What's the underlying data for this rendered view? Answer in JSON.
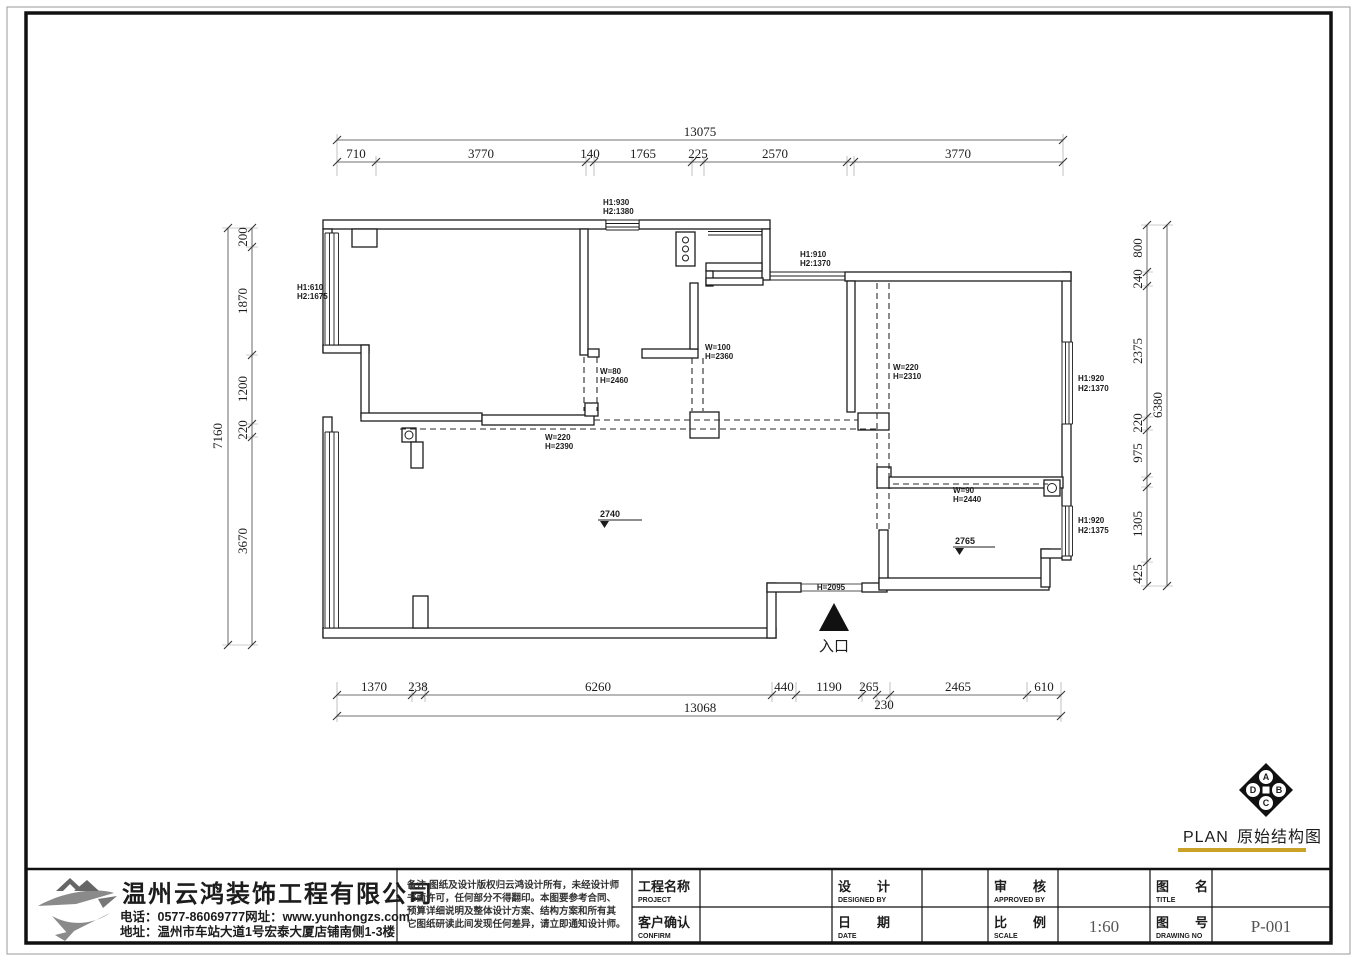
{
  "plan_title": {
    "en": "PLAN",
    "zh": "原始结构图"
  },
  "underline_color": "#c9a227",
  "dims": {
    "top_total": "13075",
    "top": [
      "710",
      "3770",
      "140",
      "1765",
      "225",
      "2570",
      "3770"
    ],
    "bottom": [
      "1370",
      "238",
      "6260",
      "440",
      "1190",
      "265",
      "2465",
      "610"
    ],
    "bottom_small": "230",
    "bottom_total": "13068",
    "left": [
      "200",
      "1870",
      "1200",
      "220",
      "3670"
    ],
    "left_total": "7160",
    "right": [
      "800",
      "240",
      "2375",
      "220",
      "975",
      "1305",
      "425"
    ],
    "right_total": "6380"
  },
  "labels": {
    "win_top_h1": "H1:930",
    "win_top_h2": "H2:1380",
    "win_right_upper_h1": "H1:910",
    "win_right_upper_h2": "H2:1370",
    "win_left_h1": "H1:610",
    "win_left_h2": "H2:1675",
    "win_east_top_h1": "H1:920",
    "win_east_top_h2": "H2:1370",
    "win_east_bottom_h1": "H1:920",
    "win_east_bottom_h2": "H2:1375",
    "door_w80_w": "W=80",
    "door_w80_h": "H=2460",
    "door_w100_w": "W=100",
    "door_w100_h": "H=2360",
    "beam_w220_w": "W=220",
    "beam_w220_h": "H=2390",
    "open_w220_w": "W=220",
    "open_w220_h": "H=2310",
    "open_w90_w": "W=90",
    "open_w90_h": "H=2440",
    "entry_height": "H=2095",
    "entry_label": "入口",
    "level_living": "2740",
    "level_br": "2765"
  },
  "compass": {
    "letters": [
      "A",
      "B",
      "C",
      "D"
    ]
  },
  "title_block": {
    "company": {
      "name": "温州云鸿装饰工程有限公司",
      "phone": "电话：0577-86069777网址：www.yunhongzs.com",
      "address": "地址：温州市车站大道1号宏泰大厦店铺南侧1-3楼"
    },
    "notes_lines": [
      "备注:图纸及设计版权归云鸿设计所有，未经设计师",
      "书面许可，任何部分不得翻印。本图要参考合同、",
      "预算详细说明及整体设计方案、结构方案和所有其",
      "它图纸研读此间发现任何差异，请立即通知设计师。"
    ],
    "fields": [
      {
        "zh": "工程名称",
        "en": "PROJECT",
        "value": ""
      },
      {
        "zh": "客户确认",
        "en": "CONFIRM",
        "value": ""
      },
      {
        "zh": "设　　计",
        "en": "DESIGNED BY",
        "value": ""
      },
      {
        "zh": "日　　期",
        "en": "DATE",
        "value": ""
      },
      {
        "zh": "审　　核",
        "en": "APPROVED BY",
        "value": ""
      },
      {
        "zh": "比　　例",
        "en": "SCALE",
        "value": "1:60"
      },
      {
        "zh": "图　　名",
        "en": "TITLE",
        "value": ""
      },
      {
        "zh": "图　　号",
        "en": "DRAWING NO",
        "value": "P-001"
      }
    ]
  }
}
